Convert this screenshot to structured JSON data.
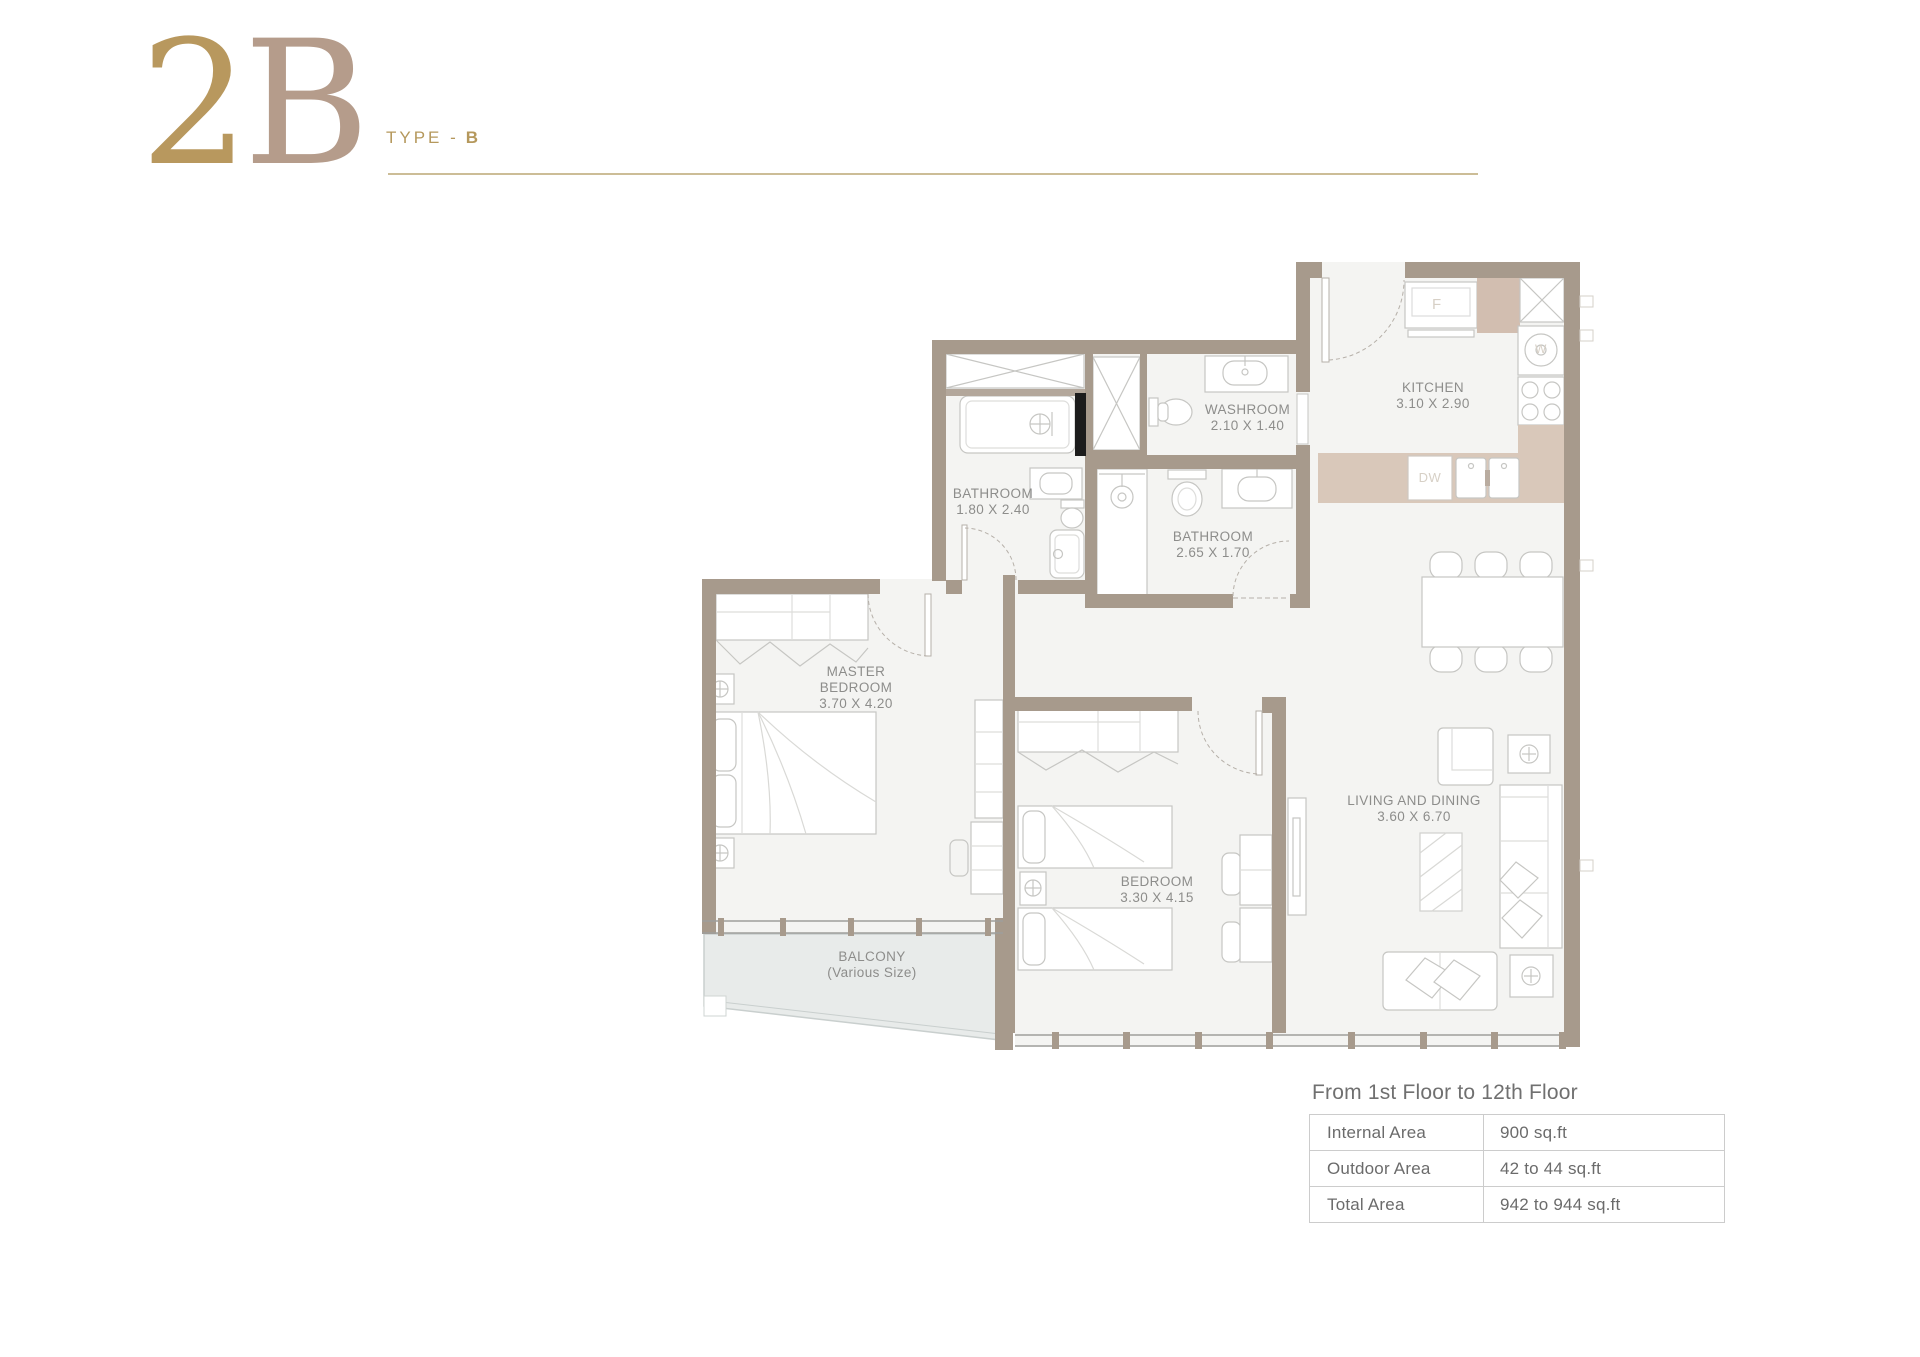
{
  "header": {
    "plan_code": "2B",
    "plan_code_parts": {
      "digit": "2",
      "letter": "B"
    },
    "type_label": "TYPE -",
    "type_value": "B"
  },
  "floor_plan": {
    "rooms": [
      {
        "id": "washroom",
        "name": "WASHROOM",
        "dims": "2.10 X 1.40"
      },
      {
        "id": "kitchen",
        "name": "KITCHEN",
        "dims": "3.10 X 2.90"
      },
      {
        "id": "bathroom-small",
        "name": "BATHROOM",
        "dims": "1.80 X 2.40"
      },
      {
        "id": "bathroom-large",
        "name": "BATHROOM",
        "dims": "2.65 X 1.70"
      },
      {
        "id": "master-bedroom",
        "name": "MASTER BEDROOM",
        "dims": "3.70 X 4.20"
      },
      {
        "id": "bedroom",
        "name": "BEDROOM",
        "dims": "3.30 X 4.15"
      },
      {
        "id": "living-dining",
        "name": "LIVING AND DINING",
        "dims": "3.60 X 6.70"
      },
      {
        "id": "balcony",
        "name": "BALCONY",
        "dims": "(Various Size)"
      }
    ],
    "appliances": {
      "fridge": "F",
      "washer": "W",
      "dishwasher": "DW"
    }
  },
  "area_table": {
    "title": "From 1st Floor to 12th Floor",
    "rows": [
      {
        "label": "Internal Area",
        "value": "900 sq.ft"
      },
      {
        "label": "Outdoor Area",
        "value": "42 to 44 sq.ft"
      },
      {
        "label": "Total Area",
        "value": "942 to 944 sq.ft"
      }
    ]
  },
  "colors": {
    "accent_gold": "#b5985c",
    "numeral_digit": "#b8985e",
    "numeral_letter": "#b59c8b",
    "header_rule": "#ccbd97",
    "wall": "#a79a8c",
    "floor": "#f4f4f2",
    "balcony_floor": "#e8ebea",
    "counter": "#d9c8ba",
    "room_label": "#8d8d8b",
    "table_border": "#cccccc",
    "table_text": "#6b6b6b"
  }
}
